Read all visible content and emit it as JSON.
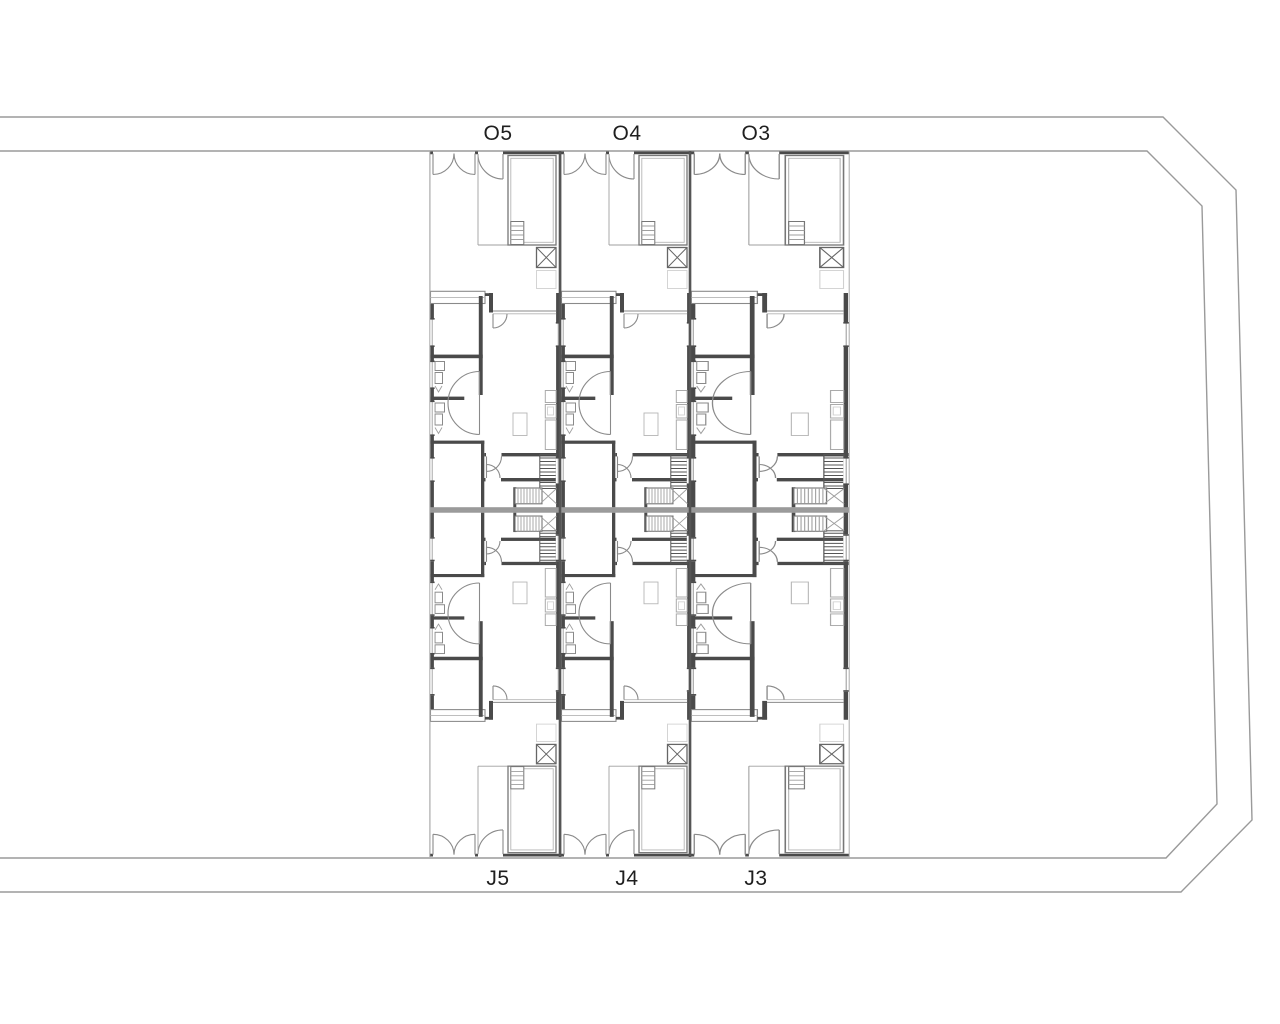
{
  "page": {
    "background_color": "#ffffff"
  },
  "drawing": {
    "line_colors": {
      "walls": "#4a4a4a",
      "thin_lines": "#8a8a8a",
      "site_boundary": "#9a9a9a",
      "labels": "#1f1f1f"
    },
    "plan": {
      "top_unit_labels": [
        "O5",
        "O4",
        "O3"
      ],
      "bottom_unit_labels": [
        "J5",
        "J4",
        "J3"
      ]
    }
  }
}
